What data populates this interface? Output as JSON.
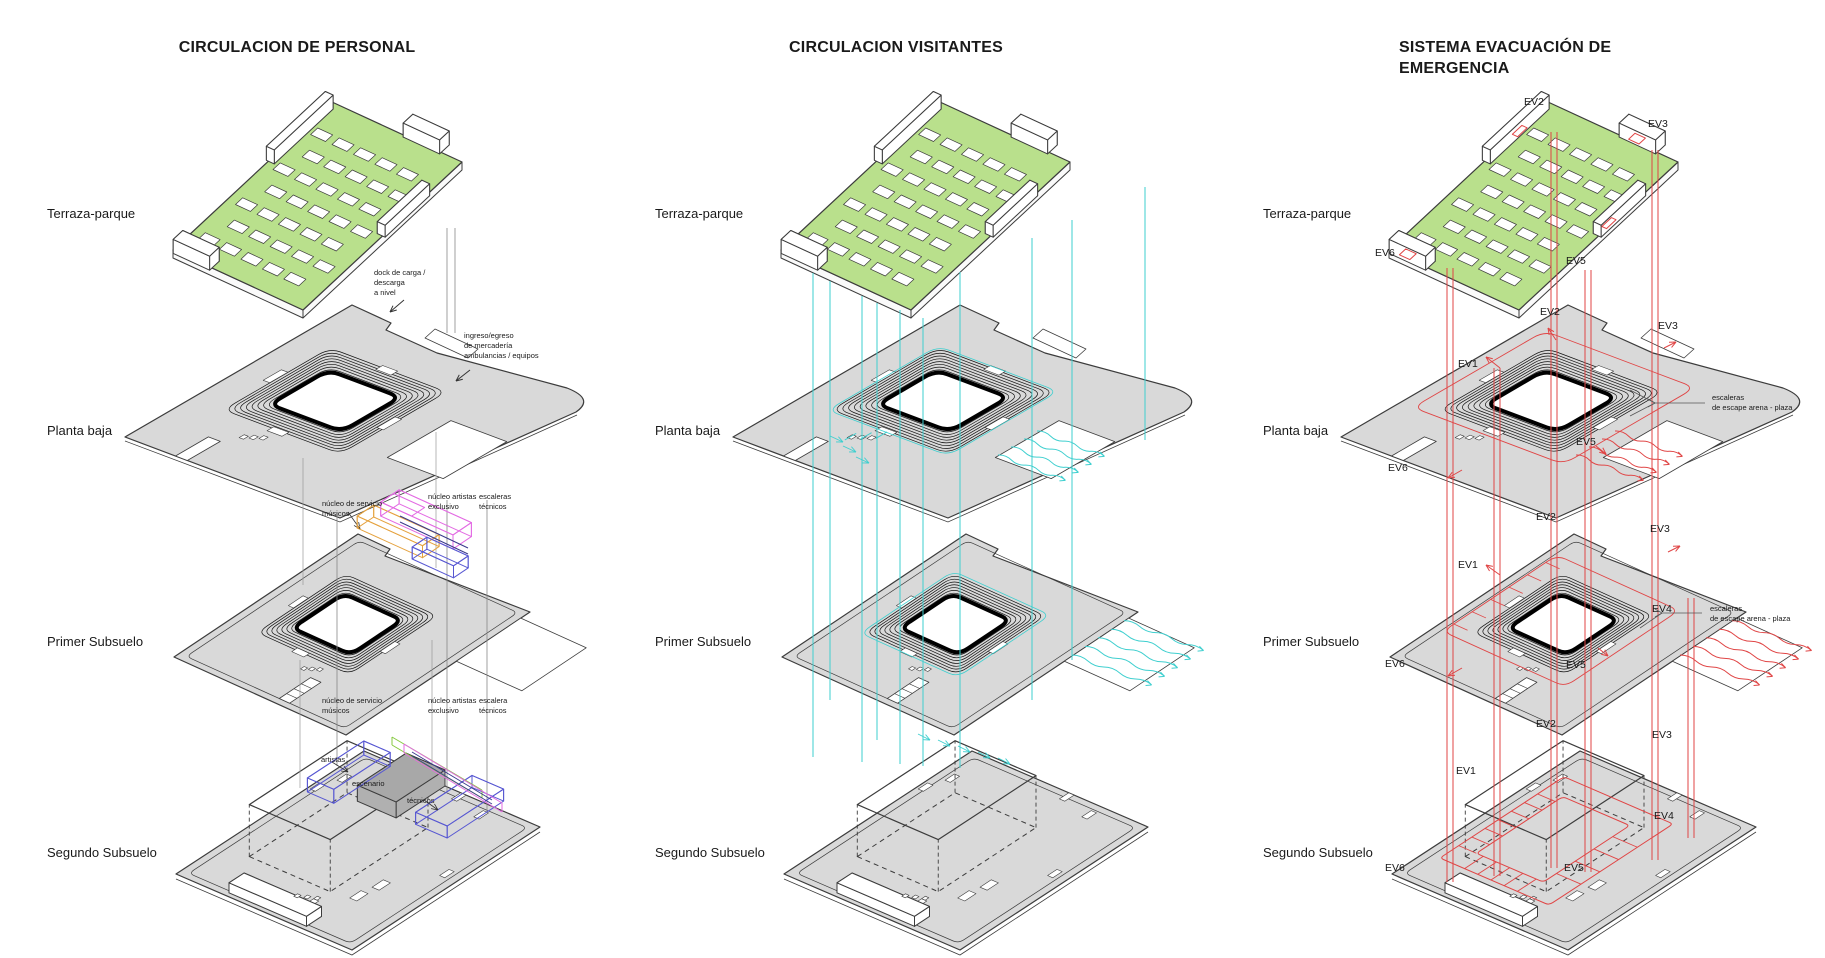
{
  "page": {
    "background": "#ffffff"
  },
  "colors": {
    "terrace_green": "#b9e08c",
    "plate_gray": "#d9d9d9",
    "outline": "#3c3c3c",
    "opening_black": "#000000",
    "visitor_cyan": "#3ecfcf",
    "emergency_red": "#e04545",
    "duct_magenta": "#e36be3",
    "duct_orange": "#e5a23e",
    "duct_blue": "#5757d2",
    "duct_lime": "#86c93f",
    "duct_navy": "#3a3a8c",
    "stage_gray": "#a8a8a8",
    "leader_gray": "#888888"
  },
  "columns": [
    {
      "id": "personal",
      "title": "CIRCULACION DE PERSONAL",
      "levels": [
        "Terraza-parque",
        "Planta baja",
        "Primer Subsuelo",
        "Segundo Subsuelo"
      ],
      "annotations": [
        {
          "text": "dock de carga /\ndescarga\na nivel",
          "x": 374,
          "y": 268
        },
        {
          "text": "ingreso/egreso\nde mercadería\nambulancias / equipos",
          "x": 464,
          "y": 331
        },
        {
          "text": "núcleo de servicio\nmúsicos",
          "x": 322,
          "y": 499
        },
        {
          "text": "núcleo artistas\nexclusivo",
          "x": 428,
          "y": 492
        },
        {
          "text": "escaleras\ntécnicos",
          "x": 479,
          "y": 492
        },
        {
          "text": "núcleo de servicio\nmúsicos",
          "x": 322,
          "y": 696
        },
        {
          "text": "núcleo artistas\nexclusivo",
          "x": 428,
          "y": 696
        },
        {
          "text": "escalera\ntécnicos",
          "x": 479,
          "y": 696
        },
        {
          "text": "artistas",
          "x": 321,
          "y": 755
        },
        {
          "text": "escenario",
          "x": 352,
          "y": 779
        },
        {
          "text": "técnicos",
          "x": 407,
          "y": 796
        }
      ]
    },
    {
      "id": "visitantes",
      "title": "CIRCULACION VISITANTES",
      "levels": [
        "Terraza-parque",
        "Planta baja",
        "Primer Subsuelo",
        "Segundo Subsuelo"
      ]
    },
    {
      "id": "emergencia",
      "title": "SISTEMA EVACUACIÓN DE EMERGENCIA",
      "levels": [
        "Terraza-parque",
        "Planta baja",
        "Primer Subsuelo",
        "Segundo Subsuelo"
      ],
      "ev_labels": [
        {
          "text": "EV2",
          "x": 1524,
          "y": 96
        },
        {
          "text": "EV3",
          "x": 1648,
          "y": 118
        },
        {
          "text": "EV6",
          "x": 1375,
          "y": 247
        },
        {
          "text": "EV5",
          "x": 1566,
          "y": 255
        },
        {
          "text": "EV2",
          "x": 1540,
          "y": 306
        },
        {
          "text": "EV3",
          "x": 1658,
          "y": 320
        },
        {
          "text": "EV1",
          "x": 1458,
          "y": 358
        },
        {
          "text": "EV5",
          "x": 1576,
          "y": 436
        },
        {
          "text": "EV6",
          "x": 1388,
          "y": 462
        },
        {
          "text": "EV2",
          "x": 1536,
          "y": 511
        },
        {
          "text": "EV3",
          "x": 1650,
          "y": 523
        },
        {
          "text": "EV1",
          "x": 1458,
          "y": 559
        },
        {
          "text": "EV4",
          "x": 1652,
          "y": 603
        },
        {
          "text": "EV5",
          "x": 1566,
          "y": 659
        },
        {
          "text": "EV6",
          "x": 1385,
          "y": 658
        },
        {
          "text": "EV2",
          "x": 1536,
          "y": 718
        },
        {
          "text": "EV3",
          "x": 1652,
          "y": 729
        },
        {
          "text": "EV1",
          "x": 1456,
          "y": 765
        },
        {
          "text": "EV4",
          "x": 1654,
          "y": 810
        },
        {
          "text": "EV5",
          "x": 1564,
          "y": 862
        },
        {
          "text": "EV6",
          "x": 1385,
          "y": 862
        }
      ],
      "escape_notes": [
        {
          "text": "escaleras\nde escape arena - plaza",
          "x": 1712,
          "y": 393
        },
        {
          "text": "escaleras\nde escape arena - plaza",
          "x": 1710,
          "y": 604
        }
      ]
    }
  ]
}
